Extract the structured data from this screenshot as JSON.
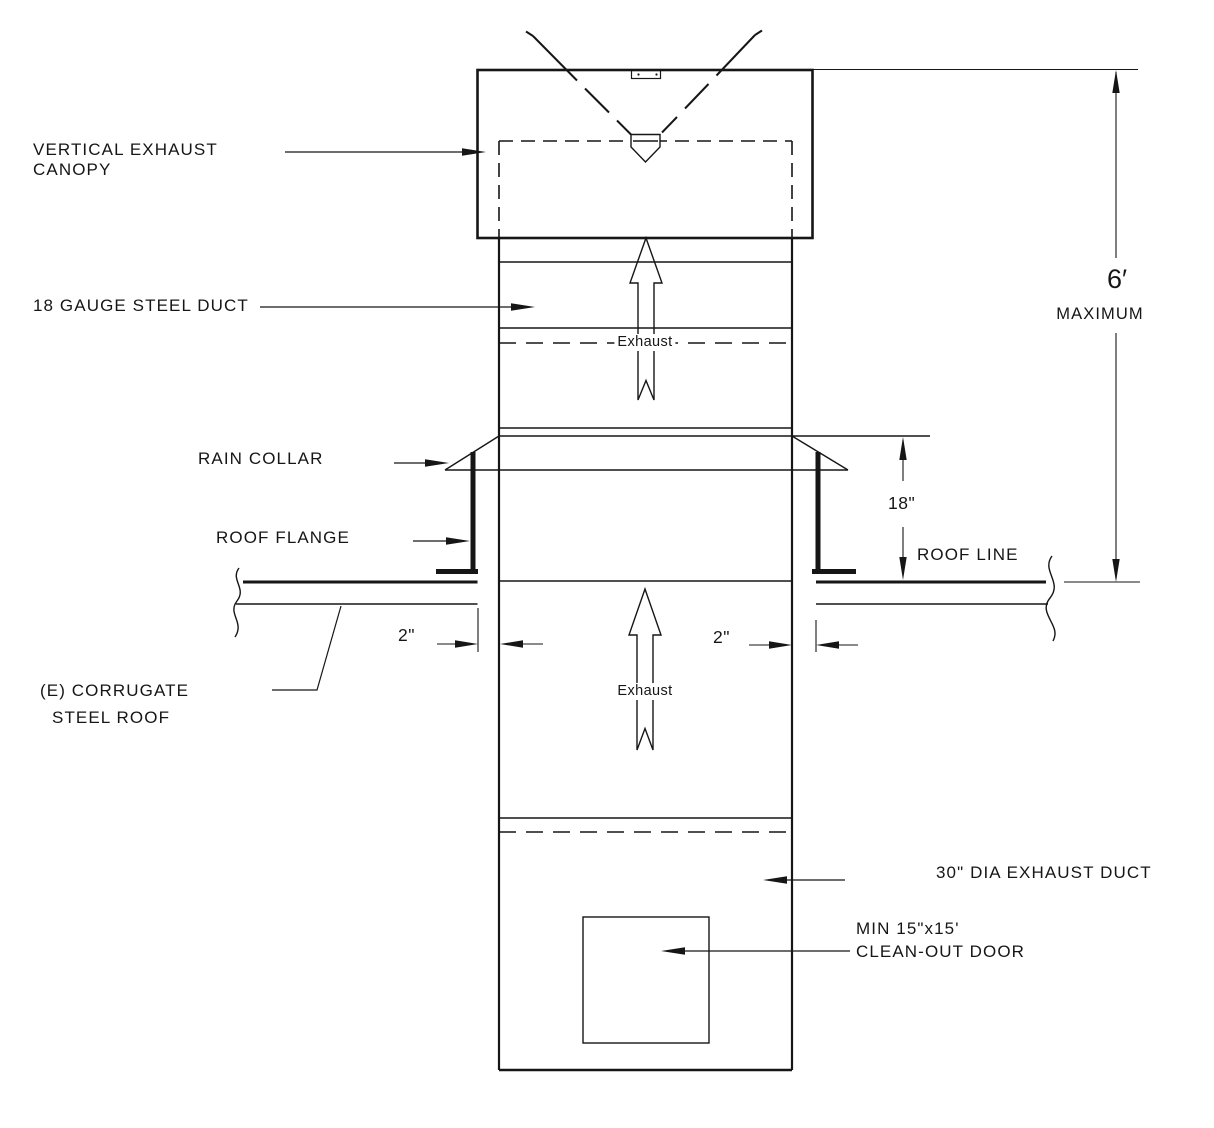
{
  "labels": {
    "canopy_line1": "VERTICAL EXHAUST",
    "canopy_line2": "CANOPY",
    "steel_duct": "18 GAUGE STEEL DUCT",
    "rain_collar": "RAIN COLLAR",
    "roof_flange": "ROOF FLANGE",
    "roof_line": "ROOF LINE",
    "corrugate_line1": "(E) CORRUGATE",
    "corrugate_line2": "STEEL ROOF",
    "dia_duct": "30\" DIA EXHAUST DUCT",
    "cleanout_line1": "MIN 15\"x15'",
    "cleanout_line2": "CLEAN-OUT DOOR",
    "exhaust_upper": "Exhaust",
    "exhaust_lower": "Exhaust"
  },
  "dimensions": {
    "max_height_value": "6′",
    "max_height_qualifier": "MAXIMUM",
    "collar_height": "18\"",
    "flange_gap_left": "2\"",
    "flange_gap_right": "2\""
  },
  "colors": {
    "line": "#161616",
    "background": "#ffffff"
  }
}
